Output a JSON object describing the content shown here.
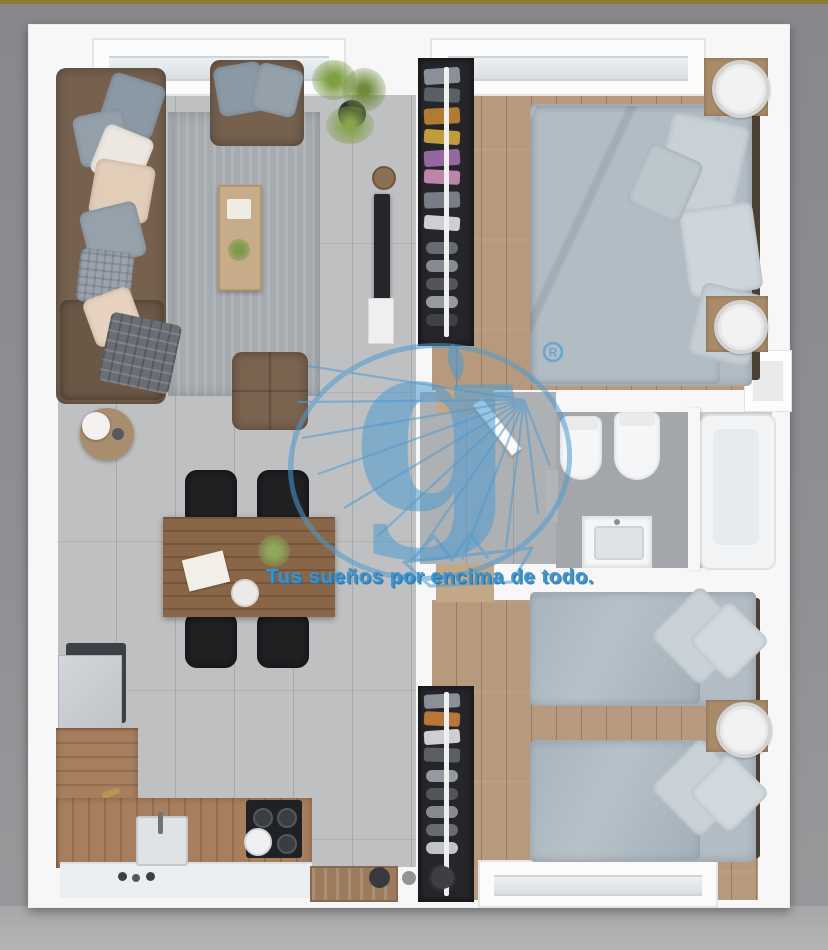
{
  "watermark": {
    "logo_letter": "g",
    "registered_symbol": "R",
    "tagline": "Tus sueños por encima de todo.",
    "logo_color": "#4E9AD0",
    "tagline_color": "#3D94CE"
  },
  "carousel": {
    "dots": [
      {
        "index": 1,
        "color": "#3a3a3e",
        "size": "large"
      },
      {
        "index": 2,
        "color": "#939395",
        "size": "small"
      },
      {
        "index": 3,
        "color": "#3f3f43",
        "size": "large"
      }
    ]
  },
  "palette": {
    "background": "#8f8f93",
    "background_bottom": "#b4b4b6",
    "top_line": "#8c7d35",
    "wall": "#f7f7f7",
    "tile_floor": "#bec0c2",
    "wood_floor": "#b79a7d",
    "hall_floor": "#aeb1b4",
    "bath_floor": "#a3a7ab",
    "sofa_brown": "#76614f",
    "bedding_grey": "#aeb9c2",
    "wardrobe_dark": "#26262a",
    "counter_wood": "#a87f5e",
    "appliance_black": "#1f2124",
    "rug_grey": "#a6abaf"
  },
  "scene": {
    "type": "3d-rendered-floor-plan",
    "rooms": [
      {
        "name": "living-dining-kitchen",
        "furniture": [
          "corner-sofa",
          "throw-pillows",
          "armchair",
          "potted-plant",
          "area-rug",
          "coffee-table",
          "side-table",
          "ottoman",
          "wall-tv",
          "dining-table",
          "dining-chairs",
          "refrigerator",
          "l-shaped-counter",
          "kitchen-sink",
          "cooktop",
          "entrance-bench"
        ]
      },
      {
        "name": "bedroom-1",
        "furniture": [
          "open-wardrobe",
          "double-bed",
          "nightstand",
          "round-lamp",
          "nightstand",
          "round-lamp"
        ]
      },
      {
        "name": "hallway",
        "furniture": [
          "door-leaf"
        ]
      },
      {
        "name": "bathroom",
        "furniture": [
          "toilet",
          "bidet",
          "washbasin-vanity",
          "bathtub"
        ]
      },
      {
        "name": "bedroom-2",
        "furniture": [
          "open-wardrobe",
          "single-bed",
          "single-bed",
          "nightstand",
          "round-lamp"
        ]
      }
    ]
  }
}
